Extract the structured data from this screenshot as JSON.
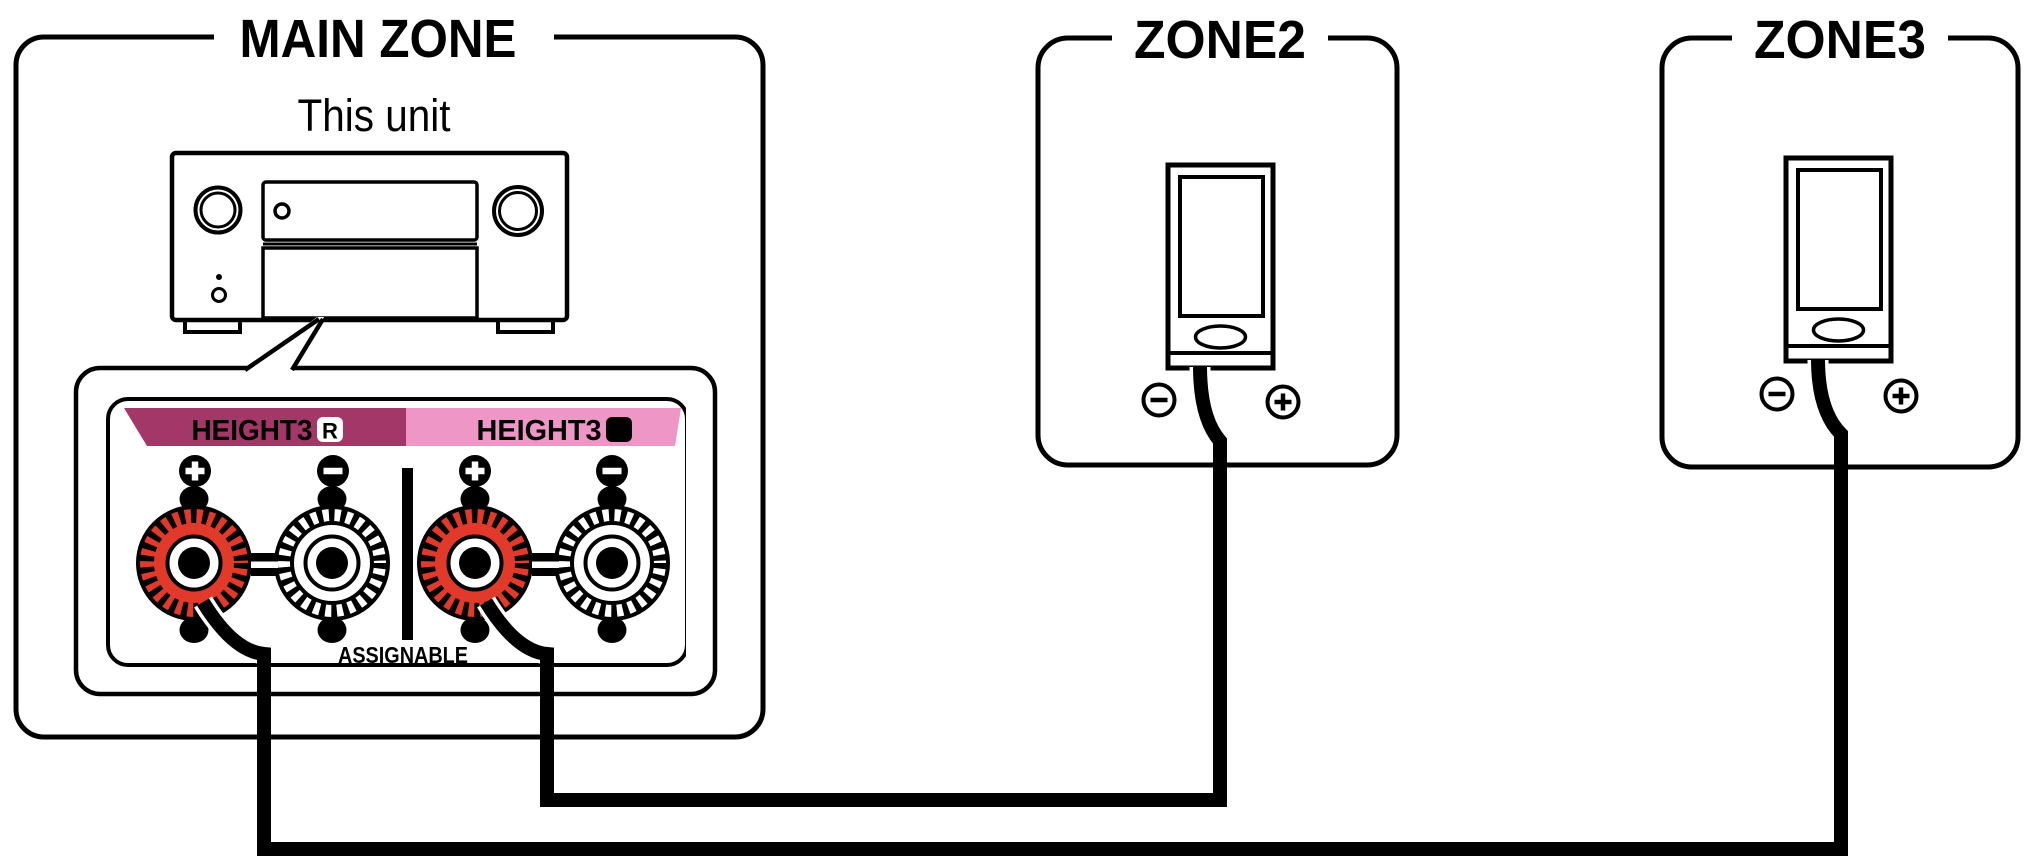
{
  "diagram": {
    "main_zone": {
      "title": "MAIN ZONE",
      "unit_label": "This unit",
      "terminal_panel": {
        "right_terminal": {
          "label": "HEIGHT3",
          "channel": "R",
          "polarity_top": [
            "+",
            "−"
          ]
        },
        "left_terminal": {
          "label": "HEIGHT3",
          "channel": "L",
          "polarity_top": [
            "+",
            "−"
          ]
        },
        "assignable_label": "ASSIGNABLE"
      }
    },
    "zone2": {
      "title": "ZONE2",
      "speaker_minus": "−",
      "speaker_plus": "+"
    },
    "zone3": {
      "title": "ZONE3",
      "speaker_minus": "−",
      "speaker_plus": "+"
    },
    "icons": {
      "plus": "+",
      "minus": "−"
    },
    "colors": {
      "terminal_red": "#e23a2a",
      "height3_r_magenta": "#a23768",
      "height3_l_pink": "#ee96c5",
      "line_black": "#000000",
      "background": "#ffffff"
    }
  }
}
